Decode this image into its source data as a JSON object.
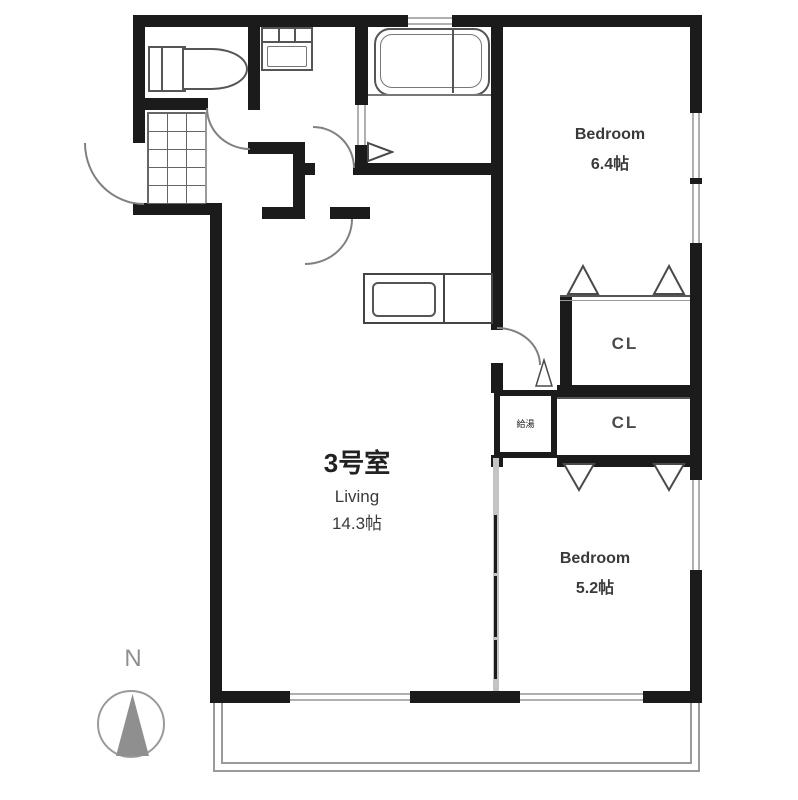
{
  "unit": {
    "label": "3号室"
  },
  "rooms": {
    "living": {
      "name": "Living",
      "area": "14.3帖"
    },
    "bedroom1": {
      "name": "Bedroom",
      "area": "6.4帖"
    },
    "bedroom2": {
      "name": "Bedroom",
      "area": "5.2帖"
    },
    "closet1": {
      "label": "CL"
    },
    "closet2": {
      "label": "CL"
    },
    "utility": {
      "label": "給湯"
    }
  },
  "compass": {
    "north_label": "N"
  },
  "colors": {
    "wall": "#1b1b1b",
    "fixture_line": "#555555",
    "window_line": "#b0b0b0",
    "compass_gray": "#8f8f8f",
    "text": "#3a3a3a"
  }
}
